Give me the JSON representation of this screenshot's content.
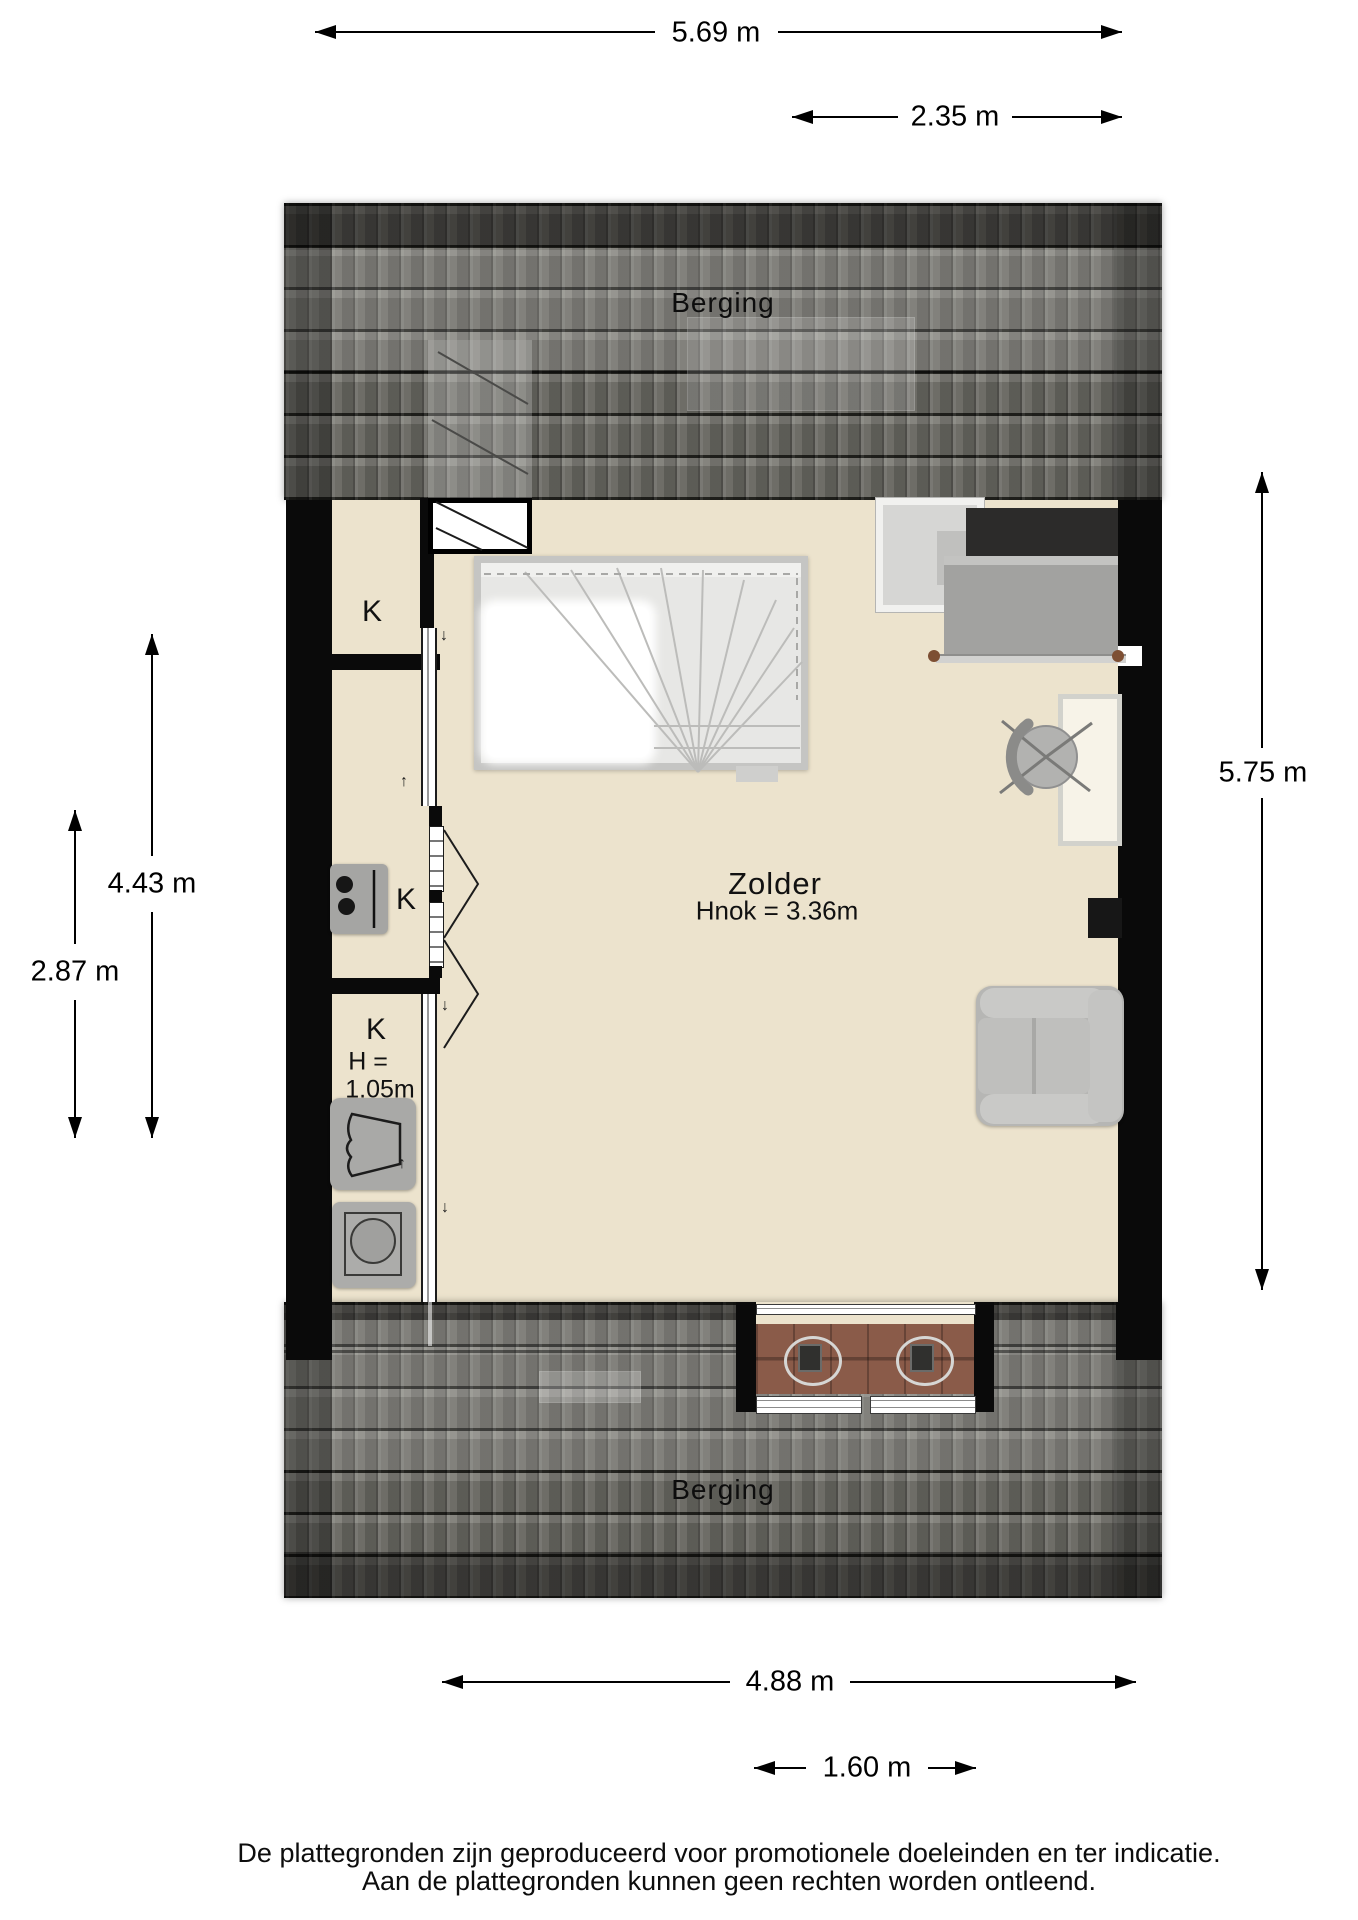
{
  "floorplan": {
    "labels": {
      "berging_top": "Berging",
      "berging_bottom": "Berging",
      "zolder": "Zolder",
      "zolder_note": "Hnok = 3.36m",
      "k_top": "K",
      "k_kitchen": "K",
      "k_low": "K",
      "k_low_h": "H =",
      "k_low_h_value": "1.05m"
    },
    "dimensions": {
      "top_width": "5.69 m",
      "top_right_width": "2.35 m",
      "right_height": "5.75 m",
      "left_height": "4.43 m",
      "left_outer_height": "2.87 m",
      "bottom_width": "4.88 m",
      "balcony_width": "1.60 m"
    },
    "markers": {
      "down": "↓",
      "up": "↑"
    },
    "colors": {
      "floor": "#ece3cd",
      "wall": "#0a0a0a",
      "roof_tile": "#6f6e68",
      "deck_wood": "#8a5b49",
      "bed_knob": "#7d4f33"
    }
  },
  "footer": {
    "line1": "De plattegronden zijn geproduceerd voor promotionele doeleinden en ter indicatie.",
    "line2": "Aan de plattegronden kunnen geen rechten worden ontleend."
  }
}
